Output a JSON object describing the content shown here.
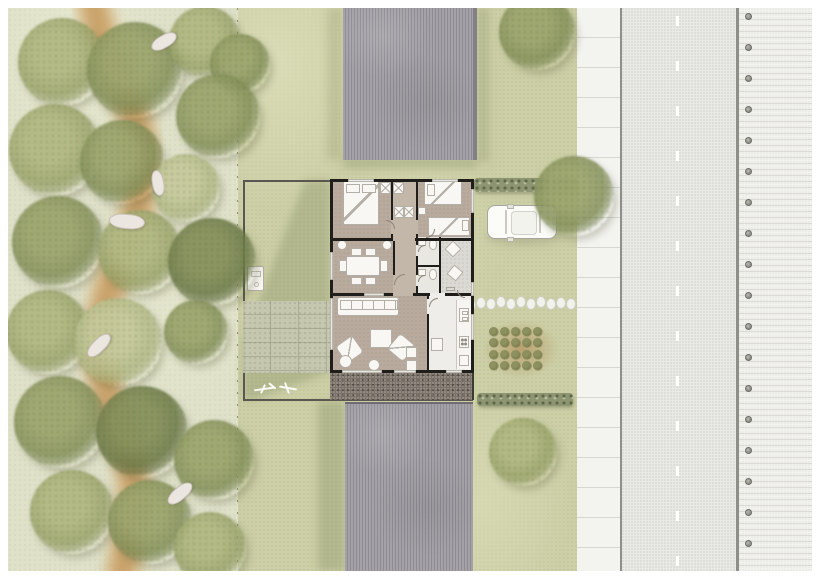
{
  "meta": {
    "drawing_type": "architectural site plan with furnished floor plan",
    "visible_text": ""
  },
  "colors": {
    "landscape": "#dfe1c9",
    "grass": "#cdd0a7",
    "path": "#cfa569",
    "pathcore": "#c1945a",
    "wall": "#1f1e1b",
    "floor": "#b9ab9d",
    "floorhall": "#c3b7a9",
    "bathfloor": "#e9e7e2",
    "porchfloor": "#dad9d4",
    "kitchenfloor": "#eeede9",
    "furn": "#f8f7f3",
    "furnline": "#b3aea6",
    "terrace": "#7b7268",
    "terracedot": "#514c44",
    "patio": "#c7c9b2",
    "patioline": "#abad95",
    "roof": "#a4a1a7",
    "roofline": "#8f8c93",
    "roofedge": "#827f87",
    "sidewalk": "#f3f3f0",
    "sidewalkline": "#d7d7d2",
    "curb": "#8f8f89",
    "road": "#e9e9e6",
    "roaddot": "#d9d9d6",
    "dash": "#ffffff",
    "pave": "#f2f2ef",
    "paveline": "#dbdad4",
    "bollard": "#90908a",
    "bollardedge": "#6e6e68",
    "hedge": "#8e9573",
    "hedgedot": "#5f6844",
    "car": "#fbfbf8",
    "carline": "#a6a69e",
    "soil": "rgba(168,116,58,0.5)",
    "plant": "#7d814f",
    "plantedge": "#5e6239",
    "stone": "#f2f2ec",
    "boundary": "#59574f",
    "animal": "#ece6e0",
    "animalline": "#cbc2bb",
    "shadow": "rgba(98,104,62,0.24)"
  },
  "scene": {
    "trees": [
      {
        "x": 62,
        "y": 62,
        "r": 44,
        "tone": 2
      },
      {
        "x": 135,
        "y": 70,
        "r": 48,
        "tone": 3
      },
      {
        "x": 205,
        "y": 42,
        "r": 36,
        "tone": 2
      },
      {
        "x": 240,
        "y": 64,
        "r": 30,
        "tone": 3
      },
      {
        "x": 218,
        "y": 116,
        "r": 42,
        "tone": 3
      },
      {
        "x": 55,
        "y": 150,
        "r": 46,
        "tone": 2
      },
      {
        "x": 122,
        "y": 162,
        "r": 42,
        "tone": 3
      },
      {
        "x": 186,
        "y": 188,
        "r": 34,
        "tone": 1
      },
      {
        "x": 58,
        "y": 242,
        "r": 46,
        "tone": 3
      },
      {
        "x": 140,
        "y": 252,
        "r": 42,
        "tone": 2
      },
      {
        "x": 212,
        "y": 262,
        "r": 44,
        "tone": 4
      },
      {
        "x": 48,
        "y": 332,
        "r": 42,
        "tone": 2
      },
      {
        "x": 118,
        "y": 342,
        "r": 44,
        "tone": 1
      },
      {
        "x": 196,
        "y": 332,
        "r": 32,
        "tone": 3
      },
      {
        "x": 60,
        "y": 422,
        "r": 46,
        "tone": 3
      },
      {
        "x": 142,
        "y": 432,
        "r": 46,
        "tone": 4
      },
      {
        "x": 214,
        "y": 460,
        "r": 40,
        "tone": 3
      },
      {
        "x": 72,
        "y": 512,
        "r": 42,
        "tone": 2
      },
      {
        "x": 150,
        "y": 522,
        "r": 42,
        "tone": 3
      },
      {
        "x": 210,
        "y": 548,
        "r": 36,
        "tone": 2
      },
      {
        "x": 537,
        "y": 32,
        "r": 38,
        "tone": 3
      },
      {
        "x": 574,
        "y": 196,
        "r": 40,
        "tone": 3
      },
      {
        "x": 523,
        "y": 452,
        "r": 34,
        "tone": 2
      }
    ],
    "animals": [
      {
        "x": 163,
        "y": 40,
        "w": 26,
        "h": 11,
        "a": -30
      },
      {
        "x": 157,
        "y": 182,
        "w": 24,
        "h": 10,
        "a": 80
      },
      {
        "x": 126,
        "y": 220,
        "w": 34,
        "h": 13,
        "a": 5
      },
      {
        "x": 98,
        "y": 344,
        "w": 28,
        "h": 11,
        "a": -45
      },
      {
        "x": 179,
        "y": 492,
        "w": 28,
        "h": 11,
        "a": -40
      }
    ],
    "stepping_stones": [
      [
        466,
        299
      ],
      [
        476,
        297
      ],
      [
        486,
        298
      ],
      [
        496,
        296
      ],
      [
        506,
        298
      ],
      [
        516,
        296
      ],
      [
        526,
        298
      ],
      [
        536,
        296
      ],
      [
        546,
        298
      ],
      [
        556,
        297
      ],
      [
        566,
        298
      ]
    ],
    "vegetable_garden": {
      "x0": 493,
      "y0": 331,
      "dx": 11,
      "dy": 11.5,
      "cols": 5,
      "rows": 4,
      "d": 9
    },
    "bollards": {
      "x": 748,
      "y0": 16,
      "step": 31,
      "count": 18,
      "d": 7
    }
  }
}
